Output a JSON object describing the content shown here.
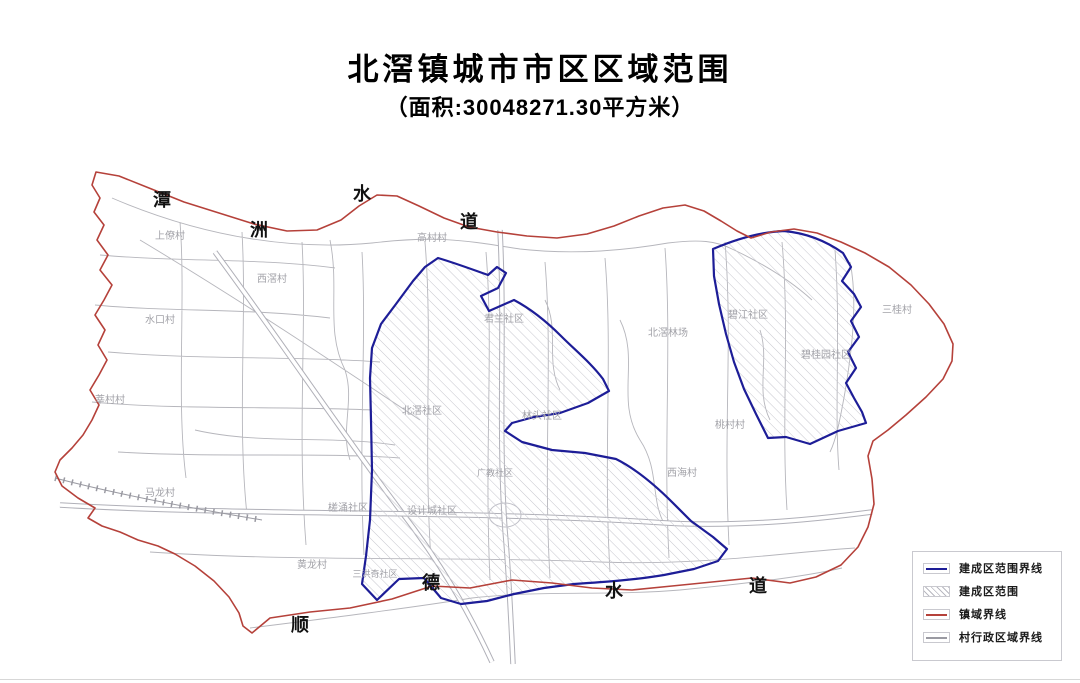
{
  "title": "北滘镇城市市区区域范围",
  "subtitle": "（面积:30048271.30平方米）",
  "map": {
    "waterway_top": {
      "name": "潭洲水道",
      "chars": [
        "潭",
        "洲",
        "水",
        "道"
      ]
    },
    "waterway_bottom": {
      "name": "顺德水道",
      "chars": [
        "顺",
        "德",
        "水",
        "道"
      ]
    },
    "labels": {
      "shangliao": "上僚村",
      "xijiao": "西滘村",
      "shuikou": "水口村",
      "xincun": "莘村村",
      "malong": "马龙村",
      "gaocun": "高村村",
      "junlan": "君兰社区",
      "beijiao_shequ": "北滘社区",
      "lintou": "林头社区",
      "guangjiao": "广教社区",
      "chayong": "槎涌社区",
      "shejicheng": "设计城社区",
      "huanglong": "黄龙村",
      "sanhongqi": "三洪奇社区",
      "beijiao_linchang": "北滘林场",
      "bijiang": "碧江社区",
      "biguiyuan": "碧桂园社区",
      "taocun": "桃村村",
      "xihai": "西海村",
      "sangui": "三桂村"
    }
  },
  "legend": {
    "items": [
      {
        "label": "建成区范围界线",
        "type": "line",
        "color": "#1d1d97"
      },
      {
        "label": "建成区范围",
        "type": "hatch",
        "color": "#b9b9c1"
      },
      {
        "label": "镇域界线",
        "type": "line",
        "color": "#b5413a"
      },
      {
        "label": "村行政区域界线",
        "type": "line",
        "color": "#9a9aa2"
      }
    ]
  },
  "colors": {
    "town_boundary": "#b5413a",
    "built_up_boundary": "#1d1d97",
    "village_boundary": "#b6b6bc",
    "hatch_line": "#c6c6ce",
    "label_text": "#a2a2a8"
  }
}
